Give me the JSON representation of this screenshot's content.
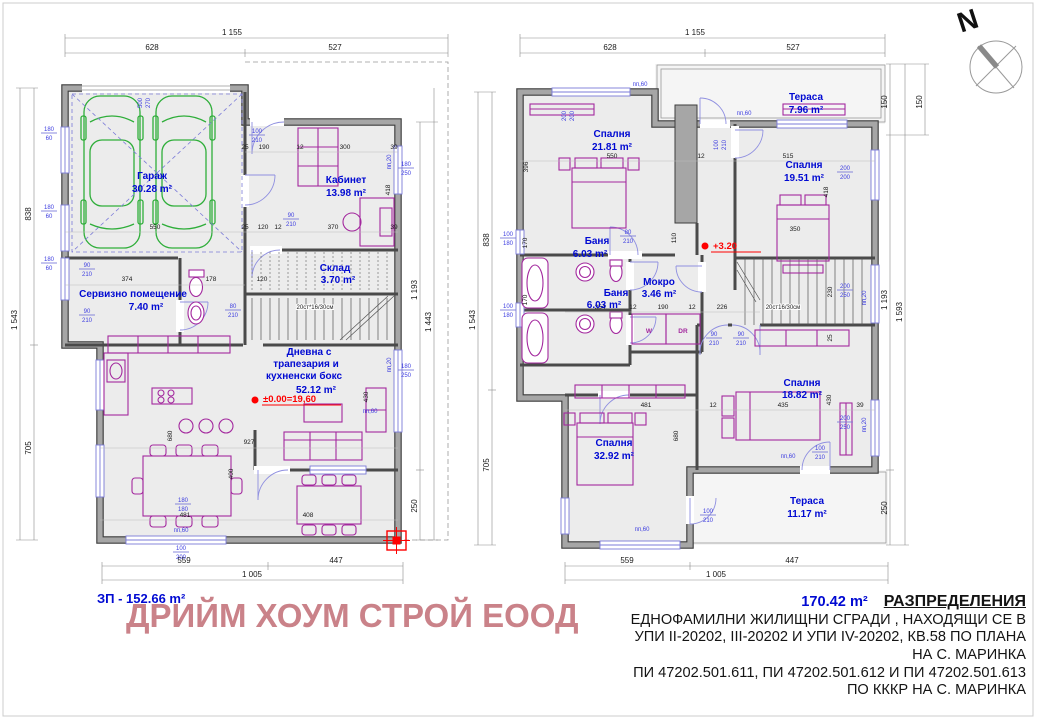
{
  "north_label": "N",
  "company_name": "ДРИЙМ ХОУМ СТРОЙ ЕООД",
  "ground_floor": {
    "area_label": "ЗП - 152.66 m²",
    "level_mark": "±0.00=19,60",
    "stairs_note": "20ст*16/30см",
    "rooms": [
      {
        "name": "Гараж",
        "area": "30.28 m²"
      },
      {
        "name": "Кабинет",
        "area": "13.98 m²"
      },
      {
        "name": "Склад",
        "area": "3.70 m²"
      },
      {
        "name": "Сервизно помещение",
        "area": "7.40 m²"
      },
      {
        "name_lines": [
          "Дневна с",
          "трапезария и",
          "кухненски бокс"
        ],
        "area": "52.12 m²"
      }
    ],
    "chain_dims": [
      "1 155",
      "628",
      "527",
      "1 543",
      "838",
      "705",
      "1 193",
      "250",
      "1 443",
      "559",
      "447",
      "1 005"
    ],
    "inner_dims": [
      "550",
      "25",
      "120",
      "12",
      "370",
      "39",
      "25",
      "190",
      "12",
      "300",
      "39",
      "374",
      "178",
      "120",
      "481",
      "408",
      "927",
      "680",
      "400",
      "430",
      "418"
    ],
    "small_dims": [
      "180",
      "60",
      "180",
      "60",
      "180",
      "60",
      "100",
      "210",
      "90",
      "210",
      "90",
      "210",
      "90",
      "210",
      "80",
      "210",
      "500",
      "270",
      "180",
      "250",
      "180",
      "250",
      "180",
      "180",
      "100",
      "200",
      "пп,60",
      "пп,60",
      "пп,20",
      "пп,20"
    ]
  },
  "upper_floor": {
    "area_label": "170.42 m²",
    "level_mark": "+3.20",
    "stairs_note": "20ст16/30см",
    "rooms": [
      {
        "name": "Спалня",
        "area": "21.81 m²"
      },
      {
        "name": "Тераса",
        "area": "7.96 m²"
      },
      {
        "name": "Спалня",
        "area": "19.51 m²"
      },
      {
        "name": "Баня",
        "area": "6.03 m²"
      },
      {
        "name": "Баня",
        "area": "6.03 m²"
      },
      {
        "name": "Мокро",
        "area": "3.46 m²"
      },
      {
        "name": "Спалня",
        "area": "18.82 m²"
      },
      {
        "name": "Спалня",
        "area": "32.92 m²"
      },
      {
        "name": "Тераса",
        "area": "11.17 m²"
      }
    ],
    "appliances": {
      "washer": "W",
      "dryer": "DR"
    },
    "chain_dims": [
      "1 155",
      "628",
      "527",
      "1 543",
      "838",
      "705",
      "150",
      "1 193",
      "250",
      "1 593",
      "150",
      "559",
      "447",
      "1 005"
    ],
    "inner_dims": [
      "550",
      "12",
      "515",
      "396",
      "170",
      "170",
      "354",
      "12",
      "190",
      "12",
      "226",
      "481",
      "12",
      "435",
      "39",
      "680",
      "430",
      "418",
      "110",
      "230",
      "25",
      "350"
    ],
    "small_dims": [
      "100",
      "180",
      "100",
      "180",
      "80",
      "210",
      "90",
      "210",
      "90",
      "210",
      "200",
      "200",
      "200",
      "250",
      "200",
      "250",
      "100",
      "210",
      "100",
      "210",
      "100",
      "210",
      "200",
      "200",
      "пп,60",
      "пп,60",
      "пп,60",
      "пп,60",
      "пп,20",
      "пп,20"
    ]
  },
  "title_block": {
    "heading": "РАЗПРЕДЕЛЕНИЯ",
    "lines": [
      "ЕДНОФАМИЛНИ ЖИЛИЩНИ СГРАДИ , НАХОДЯЩИ СЕ В",
      "УПИ II-20202, III-20202 И УПИ IV-20202, КВ.58 ПО ПЛАНА",
      "НА С. МАРИНКА",
      "ПИ 47202.501.611, ПИ 47202.501.612 И ПИ 47202.501.613",
      "ПО КККР НА С. МАРИНКА"
    ]
  },
  "colors": {
    "label_blue": "#0009d2",
    "dim_blue": "#3d3de0",
    "red": "#fe0000",
    "furniture_magenta": "#a3289e",
    "car_green": "#2fae3a",
    "company_pink": "#ca8289",
    "wall_gray": "#a6a6a6"
  }
}
